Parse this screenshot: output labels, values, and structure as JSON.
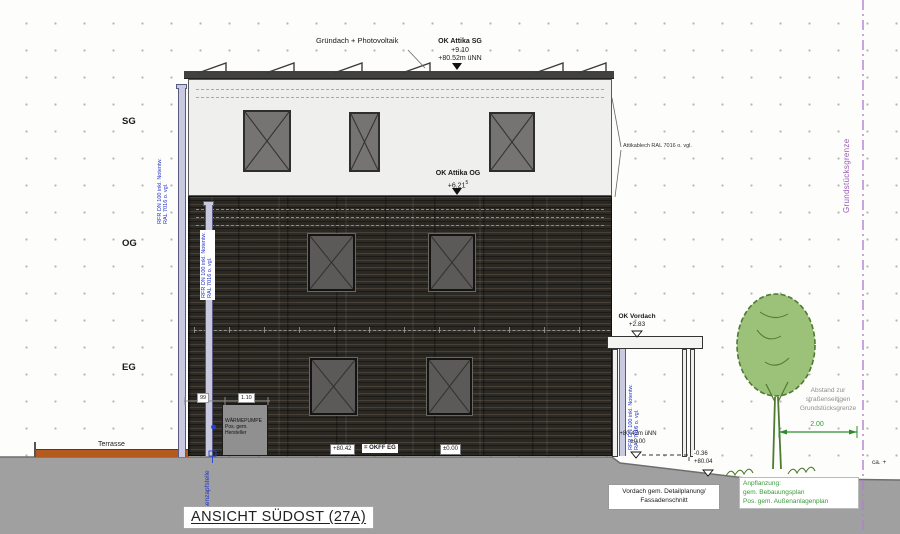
{
  "title": "ANSICHT SÜDOST (27A)",
  "floor_labels": {
    "sg": "SG",
    "og": "OG",
    "eg": "EG"
  },
  "roof_label": "Gründach + Photovoltaik",
  "levels": {
    "attika_sg": {
      "name": "OK Attika SG",
      "rel": "+9.10",
      "abs": "+80.52m üNN"
    },
    "attika_og": {
      "name": "OK Attika OG",
      "rel": "+6.21",
      "sup": "5"
    },
    "vordach": {
      "name": "OK Vordach",
      "rel": "+2.83"
    },
    "okff": {
      "abs": "+80.42",
      "eq": "= OKFF EG",
      "rel": "±0.00"
    },
    "vordach_base": {
      "abs": "+80.42m üNN",
      "rel": "±0.00"
    },
    "terrain": {
      "rel": "-0.36",
      "abs": "+80.04"
    },
    "ca": "ca. +"
  },
  "annotations": {
    "attikablech": "Attikablech RAL 7016 o. vgl.",
    "downpipe_l1": "RFR DN 100 inkl. Notentw.",
    "downpipe_l2": "RAL 7016 o. vgl.",
    "grenze": "Grundstücksgrenze",
    "terrasse": "Terrasse",
    "zapfstelle": "Außenzapfstelle",
    "waermepumpe": [
      "WÄRMEPUMPE",
      "Pos. gem.",
      "Hersteller"
    ],
    "vordach_note": [
      "Vordach gem. Detailplanung/",
      "Fassadenschnitt"
    ],
    "anpflanzung": [
      "Anpflanzung:",
      "gem. Bebauungsplan",
      "Pos. gem. Außenanlagenplan"
    ],
    "abstand": [
      "Abstand zur",
      "straßenseitigen",
      "Grundstücksgrenze"
    ]
  },
  "dimensions": {
    "left": "99",
    "mid": "1.10",
    "tree": "2.00"
  },
  "colors": {
    "facade_dark": "#2d2a25",
    "facade_light": "#efefed",
    "terrace": "#b35a1f",
    "ground": "#a0a0a0",
    "accent_blue": "#2233cc",
    "accent_green": "#2e8b2e",
    "accent_purple": "#9b59b6",
    "pipe": "#c9c9e0"
  }
}
